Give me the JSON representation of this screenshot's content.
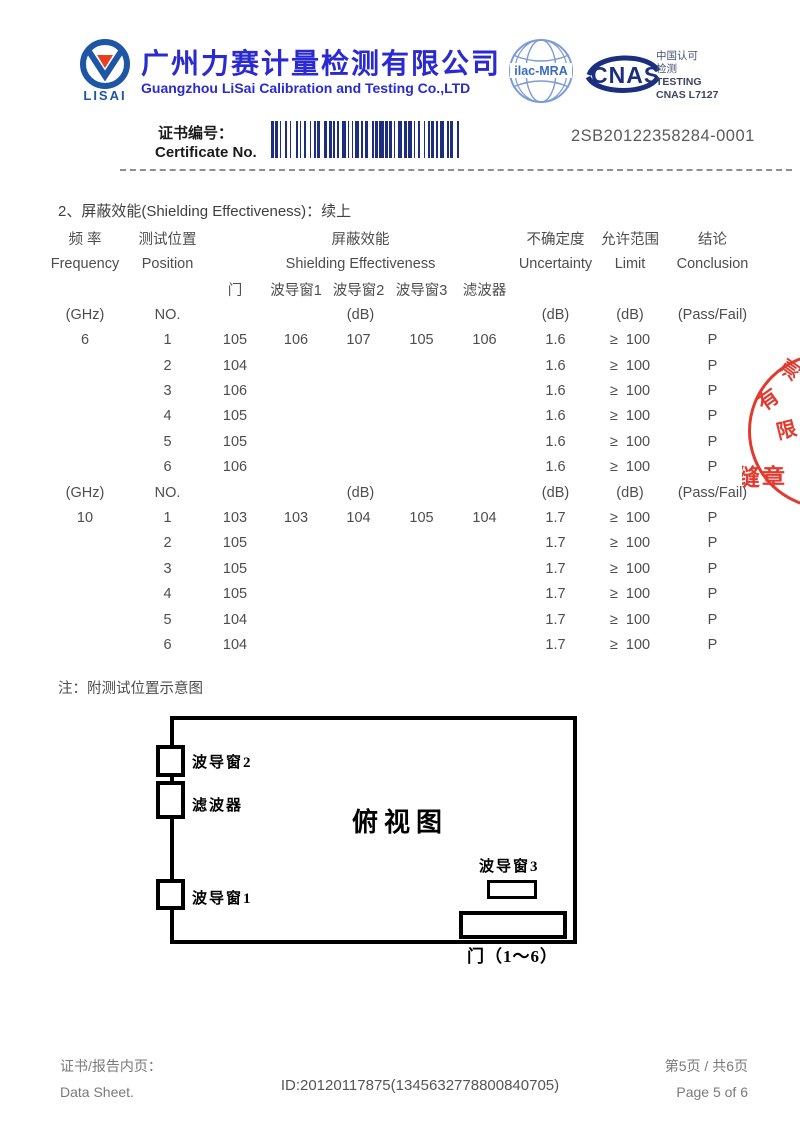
{
  "header": {
    "logo_text": "LISAI",
    "company_cn": "广州力赛计量检测有限公司",
    "company_en": "Guangzhou LiSai Calibration and Testing Co.,LTD",
    "ilac_text": "ilac-MRA",
    "cnas_text": "CNAS",
    "accreditation": {
      "line1": "中国认可",
      "line2": "检测",
      "line3": "TESTING",
      "line4": "CNAS L7127"
    }
  },
  "certificate": {
    "label_cn": "证书编号：",
    "label_en": "Certificate No.",
    "number": "2SB20122358284-0001"
  },
  "table": {
    "section_title": "2、屏蔽效能(Shielding Effectiveness)：续上",
    "head_cn": {
      "freq": "频 率",
      "pos": "测试位置",
      "se": "屏蔽效能",
      "unc": "不确定度",
      "limit": "允许范围",
      "concl": "结论"
    },
    "head_en": {
      "freq": "Frequency",
      "pos": "Position",
      "se": "Shielding Effectiveness",
      "unc": "Uncertainty",
      "limit": "Limit",
      "concl": "Conclusion"
    },
    "sub_cols": {
      "door": "门",
      "win1": "波导窗1",
      "win2": "波导窗2",
      "win3": "波导窗3",
      "filter": "滤波器"
    },
    "unit_row": {
      "freq": "(GHz)",
      "pos": "NO.",
      "se": "(dB)",
      "unc": "(dB)",
      "limit": "(dB)",
      "concl": "(Pass/Fail)"
    },
    "sections": [
      {
        "frequency": "6",
        "rows": [
          {
            "no": "1",
            "door": "105",
            "win1": "106",
            "win2": "107",
            "win3": "105",
            "filter": "106",
            "unc": "1.6",
            "limit": "≥  100",
            "concl": "P"
          },
          {
            "no": "2",
            "door": "104",
            "win1": "",
            "win2": "",
            "win3": "",
            "filter": "",
            "unc": "1.6",
            "limit": "≥  100",
            "concl": "P"
          },
          {
            "no": "3",
            "door": "106",
            "win1": "",
            "win2": "",
            "win3": "",
            "filter": "",
            "unc": "1.6",
            "limit": "≥  100",
            "concl": "P"
          },
          {
            "no": "4",
            "door": "105",
            "win1": "",
            "win2": "",
            "win3": "",
            "filter": "",
            "unc": "1.6",
            "limit": "≥  100",
            "concl": "P"
          },
          {
            "no": "5",
            "door": "105",
            "win1": "",
            "win2": "",
            "win3": "",
            "filter": "",
            "unc": "1.6",
            "limit": "≥  100",
            "concl": "P"
          },
          {
            "no": "6",
            "door": "106",
            "win1": "",
            "win2": "",
            "win3": "",
            "filter": "",
            "unc": "1.6",
            "limit": "≥  100",
            "concl": "P"
          }
        ]
      },
      {
        "frequency": "10",
        "rows": [
          {
            "no": "1",
            "door": "103",
            "win1": "103",
            "win2": "104",
            "win3": "105",
            "filter": "104",
            "unc": "1.7",
            "limit": "≥  100",
            "concl": "P"
          },
          {
            "no": "2",
            "door": "105",
            "win1": "",
            "win2": "",
            "win3": "",
            "filter": "",
            "unc": "1.7",
            "limit": "≥  100",
            "concl": "P"
          },
          {
            "no": "3",
            "door": "105",
            "win1": "",
            "win2": "",
            "win3": "",
            "filter": "",
            "unc": "1.7",
            "limit": "≥  100",
            "concl": "P"
          },
          {
            "no": "4",
            "door": "105",
            "win1": "",
            "win2": "",
            "win3": "",
            "filter": "",
            "unc": "1.7",
            "limit": "≥  100",
            "concl": "P"
          },
          {
            "no": "5",
            "door": "104",
            "win1": "",
            "win2": "",
            "win3": "",
            "filter": "",
            "unc": "1.7",
            "limit": "≥  100",
            "concl": "P"
          },
          {
            "no": "6",
            "door": "104",
            "win1": "",
            "win2": "",
            "win3": "",
            "filter": "",
            "unc": "1.7",
            "limit": "≥  100",
            "concl": "P"
          }
        ]
      }
    ]
  },
  "note": "注：附测试位置示意图",
  "diagram": {
    "title": "俯视图",
    "win2_label": "波导窗2",
    "filter_label": "滤波器",
    "win1_label": "波导窗1",
    "win3_label": "波导窗3",
    "door_label": "门（1～6）"
  },
  "stamp": {
    "char_top": "测",
    "char_mid": "有",
    "char_low": "限",
    "seal_text": "骑缝章"
  },
  "footer": {
    "left_cn": "证书/报告内页：",
    "left_en": "Data Sheet.",
    "doc_id": "ID:20120117875(1345632778800840705)",
    "right_cn": "第5页 / 共6页",
    "right_en": "Page 5 of 6"
  }
}
